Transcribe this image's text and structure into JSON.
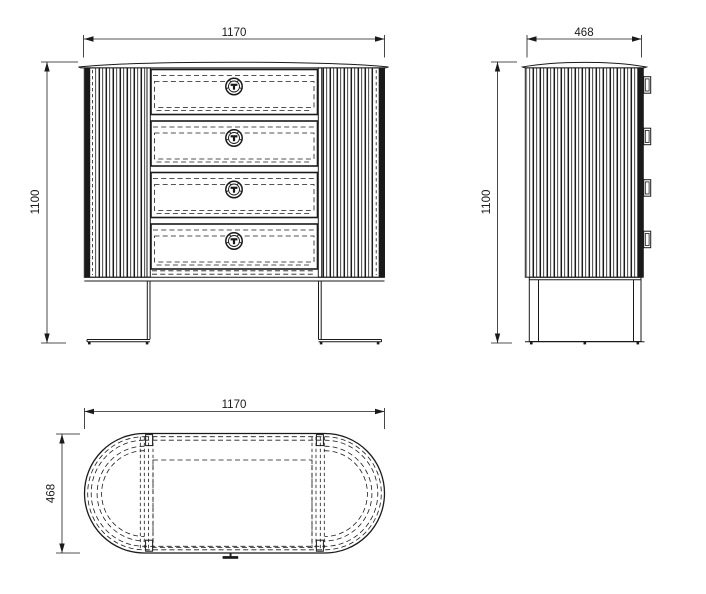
{
  "drawing": {
    "front_view": {
      "width_mm": "1170",
      "height_mm": "1100",
      "drawer_count": 4
    },
    "side_view": {
      "depth_mm": "468",
      "height_mm": "1100",
      "knob_count": 4
    },
    "top_view": {
      "width_mm": "1170",
      "depth_mm": "468"
    }
  },
  "colors": {
    "line": "#1a1a1a",
    "background": "#ffffff"
  }
}
